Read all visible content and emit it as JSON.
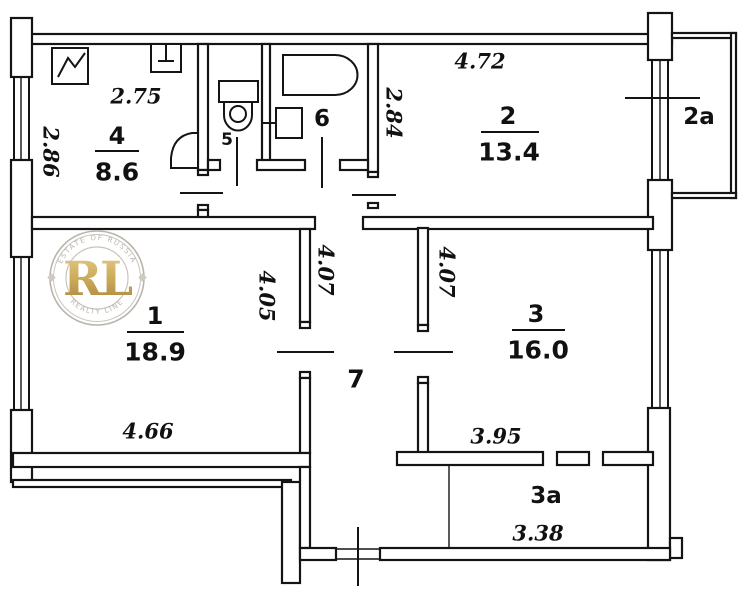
{
  "rooms": {
    "room1": {
      "number": "1",
      "area": "18.9"
    },
    "room2": {
      "number": "2",
      "area": "13.4"
    },
    "room3": {
      "number": "3",
      "area": "16.0"
    },
    "room4": {
      "number": "4",
      "area": "8.6"
    },
    "room5": {
      "number": "5"
    },
    "room6": {
      "number": "6"
    },
    "room7": {
      "number": "7"
    },
    "balcony2a": {
      "number": "2a"
    },
    "balcony3a": {
      "number": "3a"
    }
  },
  "dimensions": {
    "room4_width": "2.75",
    "room4_depth": "2.86",
    "room2_width": "4.72",
    "room2_depth": "2.84",
    "corridor_depth": "4.07",
    "room1_depth": "4.05",
    "room3_depth": "4.07",
    "room1_width": "4.66",
    "room3_width": "3.95",
    "balcony3a_width": "3.38"
  },
  "watermark": {
    "initials": "RL",
    "arc_top": "ESTATE OF RUSSIA",
    "arc_bottom": "REALTY LINE"
  },
  "colors": {
    "wall": "#141414",
    "logo_gold_light": "#e3c87e",
    "logo_gold_dark": "#9e7427",
    "logo_gray": "#b3ada3"
  }
}
